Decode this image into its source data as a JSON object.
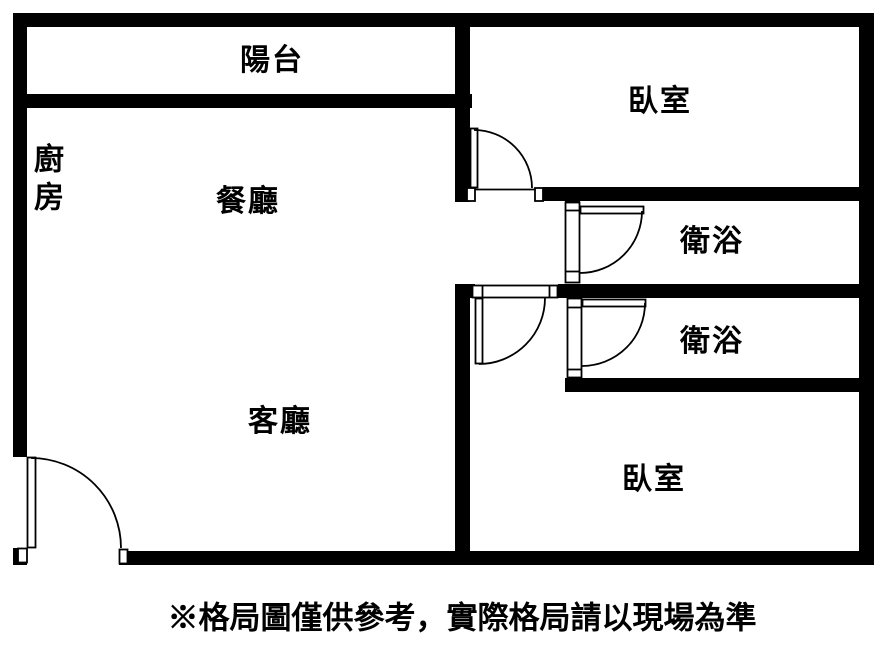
{
  "colors": {
    "background": "#ffffff",
    "walls": "#000000",
    "text": "#000000"
  },
  "rooms": {
    "balcony": {
      "label": "陽台"
    },
    "kitchen": {
      "label": "廚房"
    },
    "dining": {
      "label": "餐廳"
    },
    "bedroom_top": {
      "label": "臥室"
    },
    "bath_upper": {
      "label": "衛浴"
    },
    "bath_lower": {
      "label": "衛浴"
    },
    "living": {
      "label": "客廳"
    },
    "bedroom_bottom": {
      "label": "臥室"
    }
  },
  "disclaimer": "※格局圖僅供參考，實際格局請以現場為準"
}
